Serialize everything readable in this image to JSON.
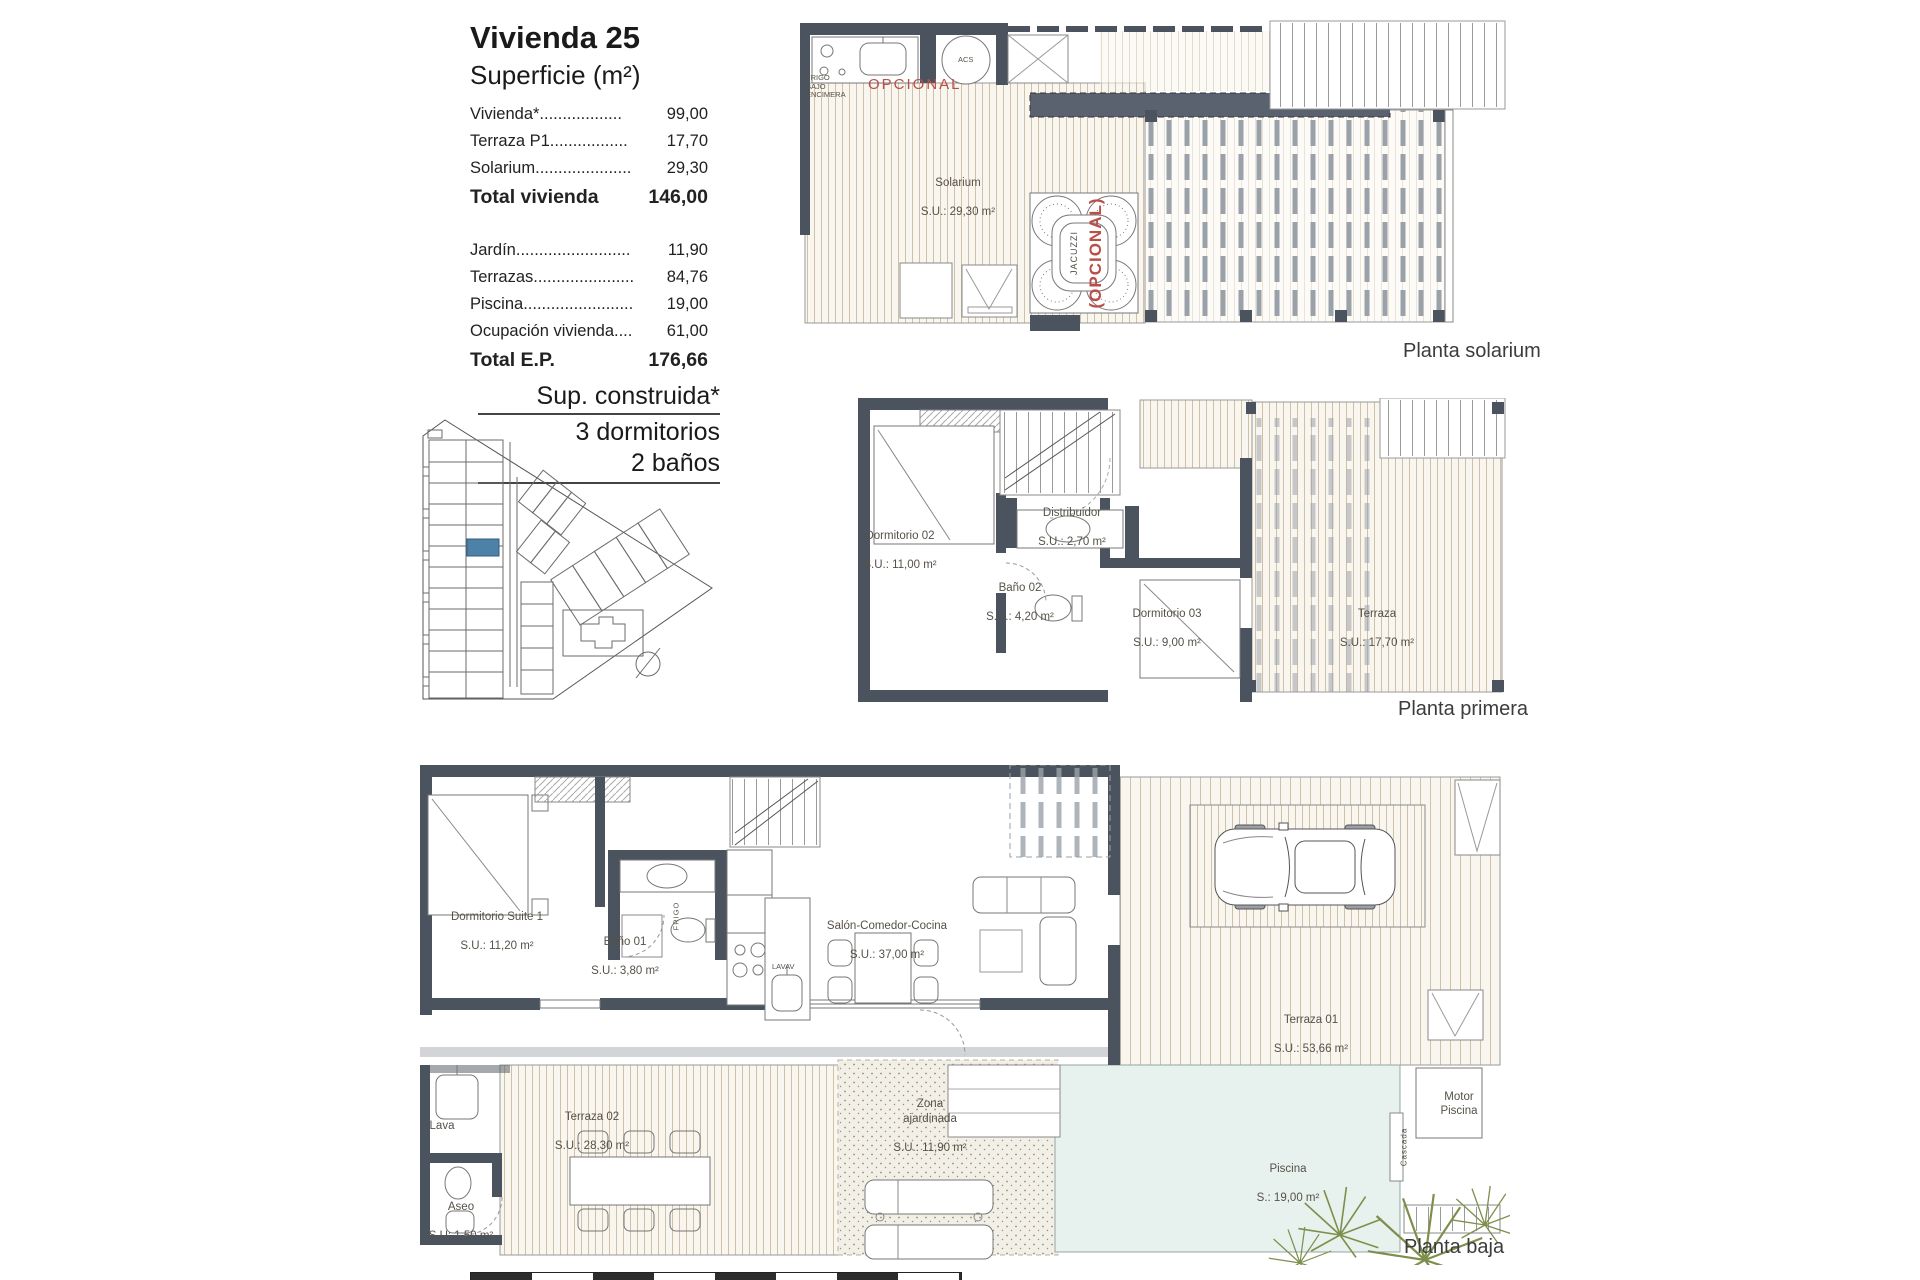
{
  "info": {
    "title": "Vivienda 25",
    "subtitle": "Superficie (m²)",
    "rows": [
      {
        "label": "Vivienda*..................",
        "value": "99,00"
      },
      {
        "label": "Terraza P1.................",
        "value": "17,70"
      },
      {
        "label": "Solarium.....................",
        "value": "29,30"
      },
      {
        "label": "Total vivienda",
        "value": "146,00"
      },
      {
        "label": "Jardín.........................",
        "value": "11,90"
      },
      {
        "label": "Terrazas......................",
        "value": "84,76"
      },
      {
        "label": "Piscina........................",
        "value": "19,00"
      },
      {
        "label": "Ocupación vivienda....",
        "value": "61,00"
      },
      {
        "label": "Total E.P.",
        "value": "176,66"
      }
    ],
    "construida": {
      "line1": "Sup. construida*",
      "line2": "3 dormitorios",
      "line3": "2 baños"
    }
  },
  "plans": {
    "solarium": {
      "name": "Planta solarium",
      "room": "Solarium",
      "room_area": "S.U.: 29,30 m²",
      "opcional": "OPCIONAL",
      "jacuzzi": "JACUZZI",
      "jacuzzi_note": "(OPCIONAL)",
      "frigo": "FRIGO\nBAJO\nENCIMERA",
      "acs": "ACS"
    },
    "primera": {
      "name": "Planta primera",
      "rooms": [
        {
          "name": "Dormitorio 02",
          "area": "S.U.: 11,00 m²"
        },
        {
          "name": "Distribuidor",
          "area": "S.U.: 2,70 m²"
        },
        {
          "name": "Baño 02",
          "area": "S.U.: 4,20 m²"
        },
        {
          "name": "Dormitorio 03",
          "area": "S.U.: 9,00 m²"
        },
        {
          "name": "Terraza",
          "area": "S.U.: 17,70 m²"
        }
      ]
    },
    "baja": {
      "name": "Planta baja",
      "rooms": [
        {
          "name": "Dormitorio Suite 1",
          "area": "S.U.: 11,20 m²"
        },
        {
          "name": "Baño 01",
          "area": "S.U.: 3,80 m²"
        },
        {
          "name": "Salón-Comedor-Cocina",
          "area": "S.U.: 37,00 m²"
        },
        {
          "name": "Terraza 01",
          "area": "S.U.: 53,66 m²"
        },
        {
          "name": "Terraza 02",
          "area": "S.U.: 28,30 m²"
        },
        {
          "name": "Zona\najardinada",
          "area": "S.U.: 11,90 m²"
        },
        {
          "name": "Piscina",
          "area": "S.: 19,00 m²"
        },
        {
          "name": "Aseo",
          "area": "S.U: 1,50 m²"
        }
      ],
      "labels": {
        "lava": "Lava",
        "motor": "Motor\nPiscina",
        "cascada": "Cascada",
        "frigo": "FRIGO",
        "lavav": "LAVAV"
      }
    }
  },
  "colors": {
    "accent_red": "#b94f48",
    "highlight_blue": "#4e81a8",
    "pool": "#e7f1ee",
    "wall": "#4b545e",
    "deck_line": "#cec1a8"
  }
}
